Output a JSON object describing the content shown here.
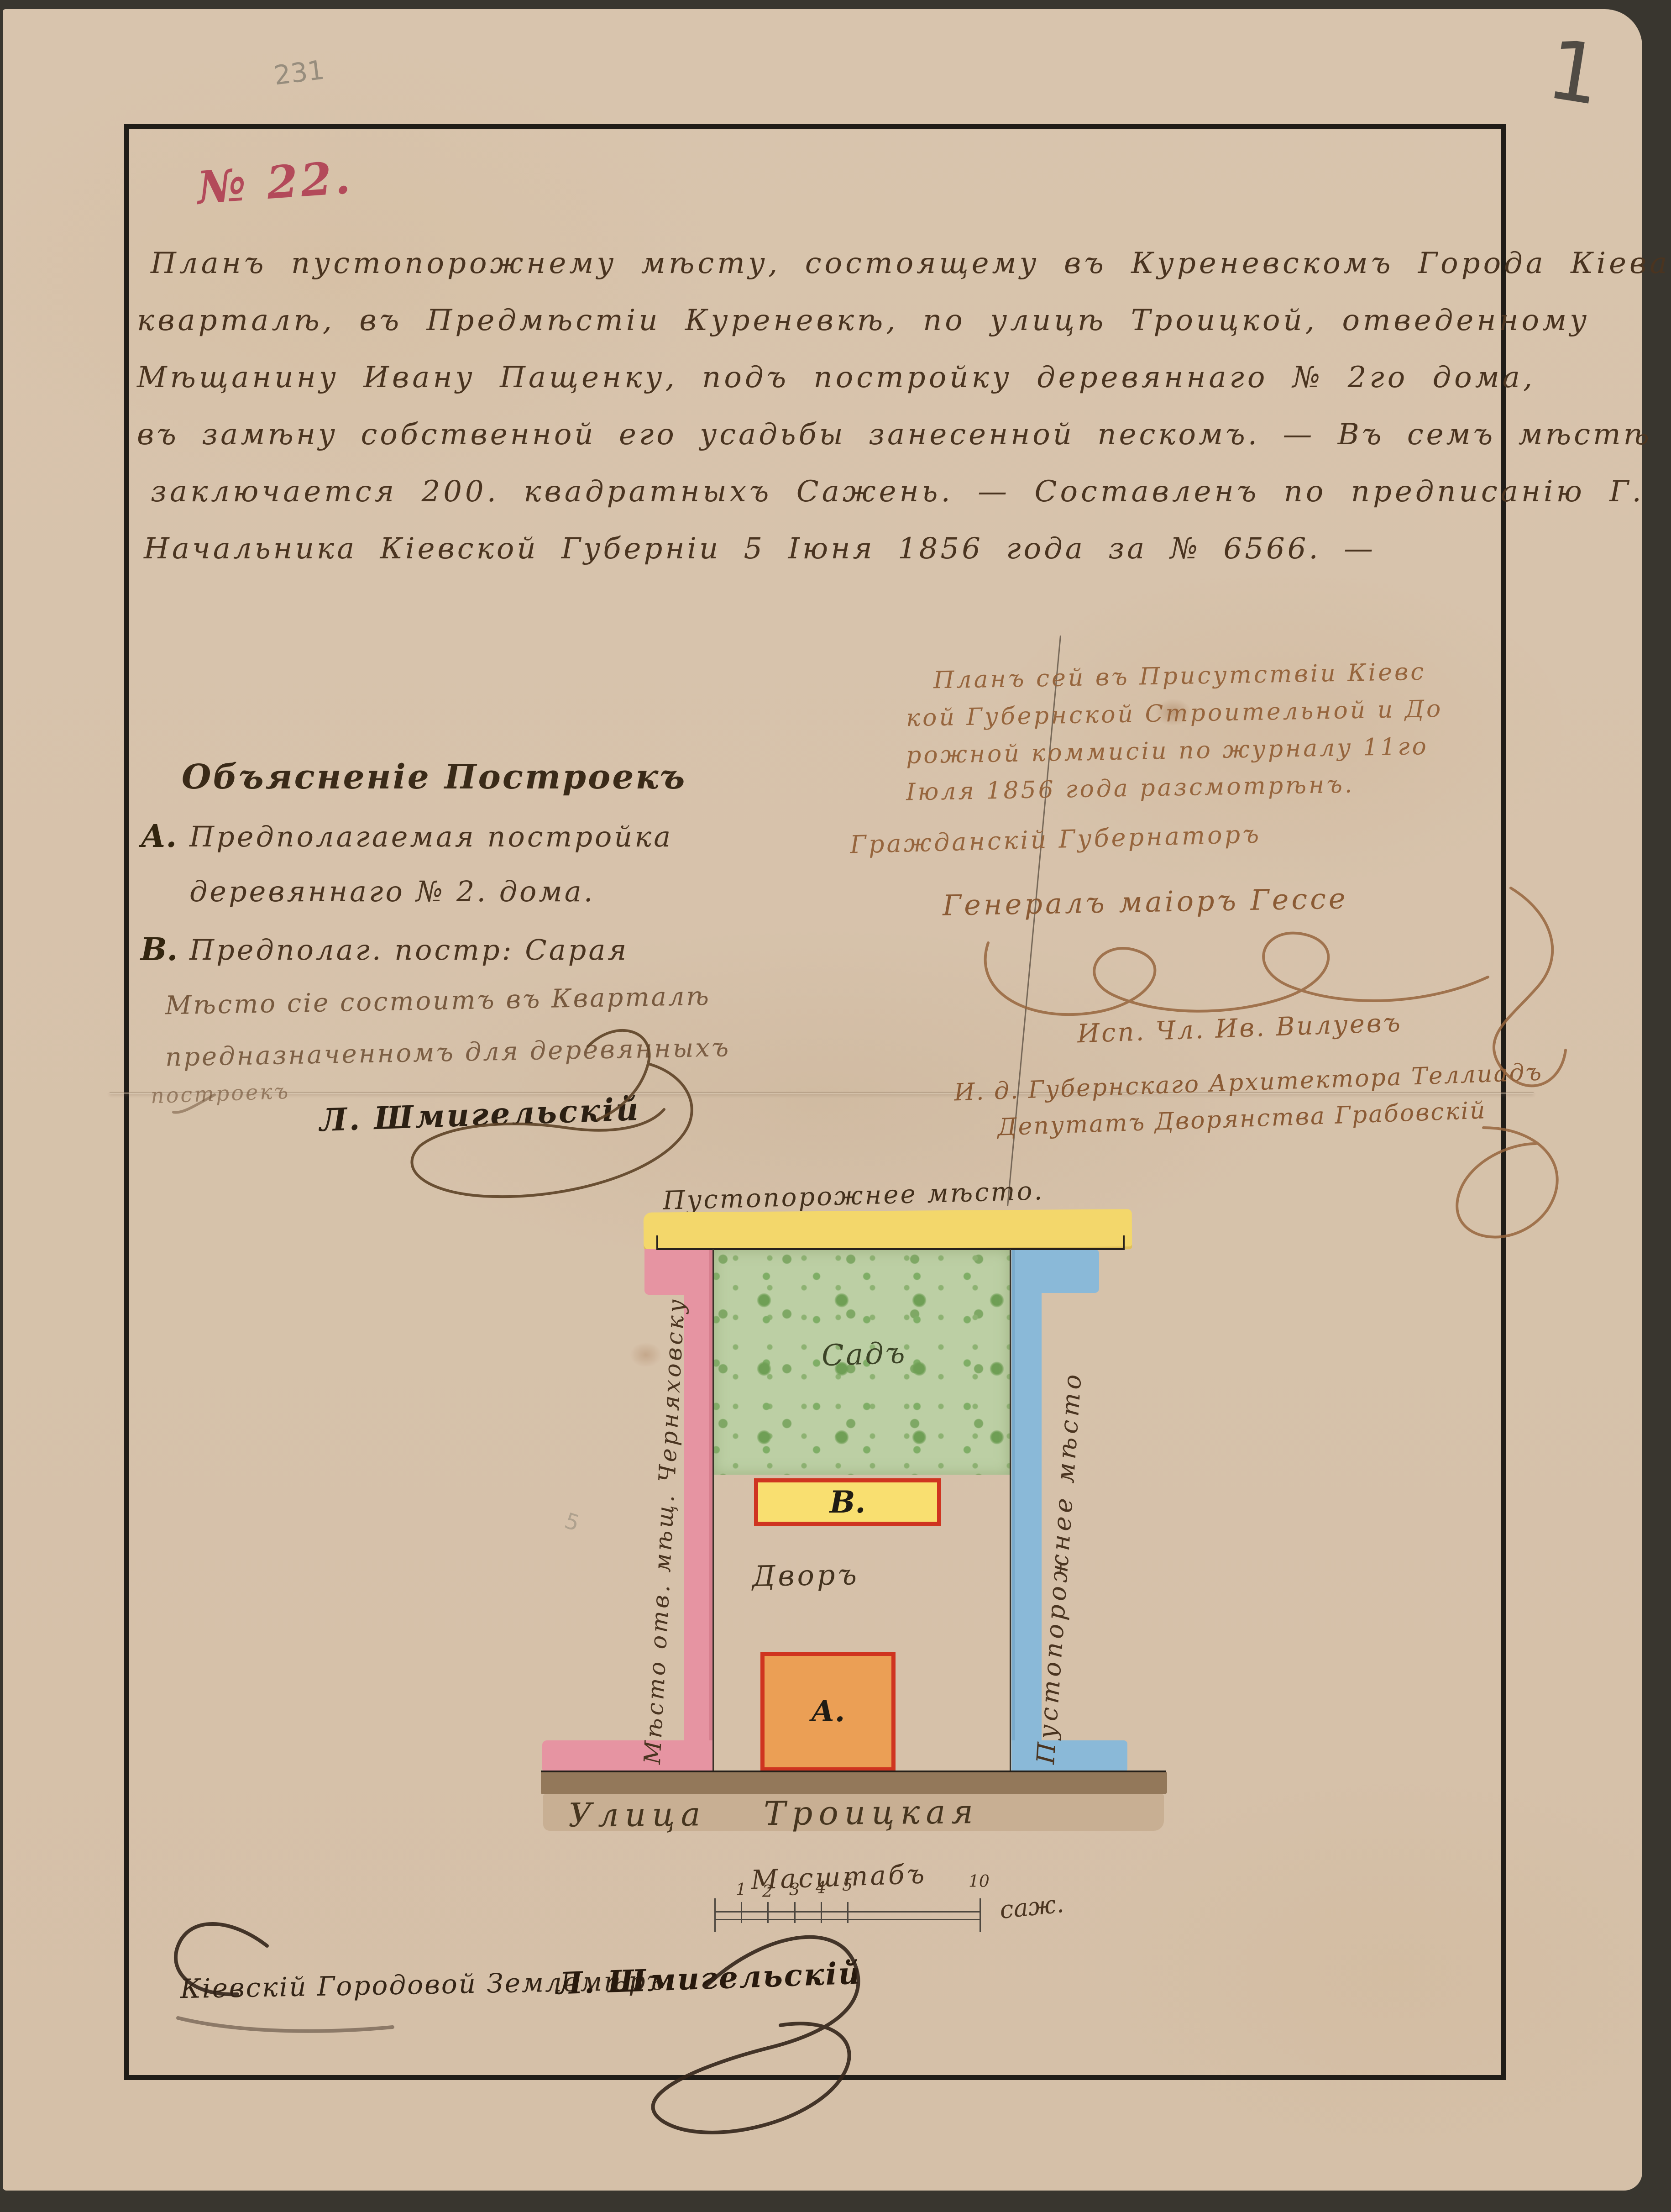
{
  "page": {
    "archival_pencil_number": "231",
    "sheet_number": "1",
    "doc_number": "№ 22.",
    "pencil_squiggle": "5"
  },
  "body": {
    "lines": [
      "Планъ пустопорожнему мѣсту, состоящему въ Куреневскомъ Города Кіева",
      "кварталѣ, въ Предмѣстіи Куреневкѣ, по улицѣ Троицкой, отведенному",
      "Мѣщанину Ивану Пащенку, подъ постройку деревяннаго № 2го дома,",
      "въ замѣну собственной его усадьбы занесенной пескомъ. — Въ семъ мѣстѣ",
      "заключается 200. квадратныхъ Сажень. — Составленъ по предписанію Г.",
      "Начальника Кіевской Губерніи 5 Іюня 1856 года за № 6566. —"
    ]
  },
  "approval": {
    "lines": [
      "Планъ сей въ Присутствіи Кіевс",
      "кой Губернской Строительной и До",
      "рожной коммисіи по журналу 11го",
      "Іюля 1856 года разсмотрѣнъ."
    ],
    "title": "Гражданскій Губернаторъ",
    "governor_signature": "Генералъ маіоръ Гессе",
    "member_signature": "Исп. Чл. Ив. Вилуевъ",
    "architect_signature": "И. д. Губернскаго Архитектора Теллиадъ",
    "deputy_signature": "Депутатъ Дворянства Грабовскій"
  },
  "legend": {
    "heading": "Объясненіе Построекъ",
    "item_a_key": "А.",
    "item_a_line1": "Предполагаемая постройка",
    "item_a_line2": "деревяннаго № 2. дома.",
    "item_b_key": "В.",
    "item_b_text": "Предполаг. постр: Сарая",
    "note_line1": "Мѣсто сіе состоитъ въ Кварталѣ",
    "note_line2": "предназначенномъ для деревянныхъ",
    "note_line3": "построекъ",
    "surveyor_signature": "Л. Шмигельскій"
  },
  "plan": {
    "top_label": "Пустопорожнее мѣсто.",
    "left_label": "Мѣсто отв. мѣщ. Черняховску",
    "right_label": "Пустопорожнее мѣсто",
    "garden_label": "Садъ",
    "yard_label": "Дворъ",
    "building_a_label": "А.",
    "building_b_label": "В.",
    "street_label": "Улица  Троицкая"
  },
  "scale": {
    "title": "Масштабъ",
    "tick_labels": [
      "1",
      "2",
      "3",
      "4",
      "5",
      "10"
    ],
    "unit": "саж."
  },
  "footer": {
    "line": "Кіевскій Городовой Землемѣръ",
    "signature": "Л. Шмигельскій"
  },
  "colors": {
    "paper": "#d8c4ad",
    "ink": "#4a3420",
    "light_ink": "#96653d",
    "red_ink": "#b34a5a",
    "garden_green": "#bccfa4",
    "garden_blob_green": "#6f9f55",
    "band_yellow": "#f3d76b",
    "strip_pink": "#e694a2",
    "strip_blue": "#8ab9d8",
    "building_orange": "#eb9f55",
    "building_yellow": "#f9df70",
    "building_border_red": "#cf3420",
    "street_brown": "#93785a",
    "street_tan": "#c8af93",
    "frame_black": "#201d18"
  }
}
